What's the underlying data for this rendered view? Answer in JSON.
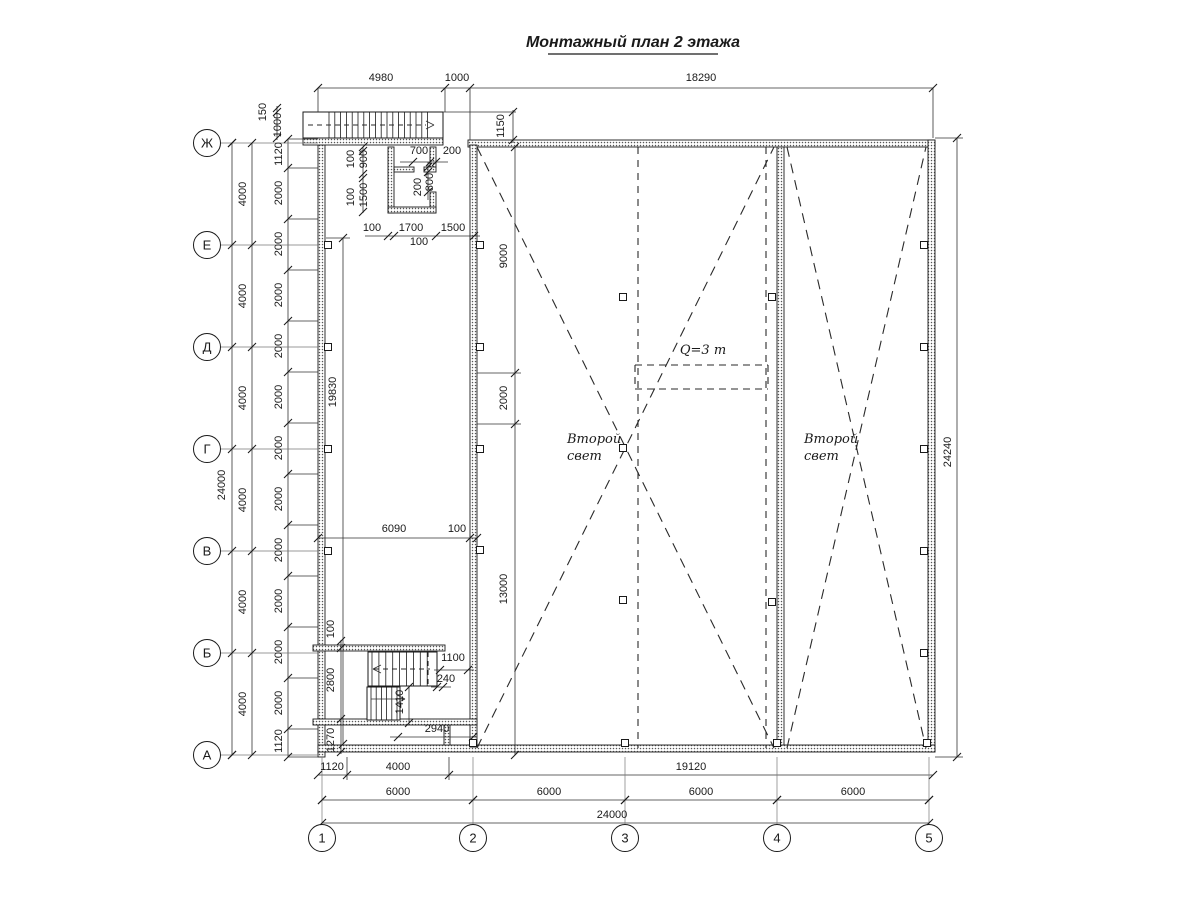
{
  "title": {
    "text": "Монтажный план 2 этажа"
  },
  "colors": {
    "bg": "#ffffff",
    "line": "#1a1a1a",
    "dim": "#333333",
    "hatch_dot": "#555555"
  },
  "axis_bubbles": {
    "rows": [
      {
        "label": "Ж",
        "x": 207,
        "y": 143
      },
      {
        "label": "Е",
        "x": 207,
        "y": 245
      },
      {
        "label": "Д",
        "x": 207,
        "y": 347
      },
      {
        "label": "Г",
        "x": 207,
        "y": 449
      },
      {
        "label": "В",
        "x": 207,
        "y": 551
      },
      {
        "label": "Б",
        "x": 207,
        "y": 653
      },
      {
        "label": "А",
        "x": 207,
        "y": 755
      }
    ],
    "cols": [
      {
        "label": "1",
        "x": 322,
        "y": 838
      },
      {
        "label": "2",
        "x": 473,
        "y": 838
      },
      {
        "label": "3",
        "x": 625,
        "y": 838
      },
      {
        "label": "4",
        "x": 777,
        "y": 838
      },
      {
        "label": "5",
        "x": 929,
        "y": 838
      }
    ]
  },
  "annotations": {
    "second_light_left": {
      "lines": [
        "Второй",
        "свет"
      ],
      "x": 567,
      "y": 443
    },
    "second_light_right": {
      "lines": [
        "Второй",
        "свет"
      ],
      "x": 804,
      "y": 443
    },
    "crane": {
      "text": "Q=3 т",
      "x": 703,
      "y": 354
    }
  },
  "dim_labels": [
    {
      "t": "4980",
      "x": 381,
      "y": 81,
      "r": 0
    },
    {
      "t": "1000",
      "x": 457,
      "y": 81,
      "r": 0
    },
    {
      "t": "18290",
      "x": 701,
      "y": 81,
      "r": 0
    },
    {
      "t": "150",
      "x": 266,
      "y": 112,
      "r": -90
    },
    {
      "t": "1000",
      "x": 281,
      "y": 125,
      "r": -90
    },
    {
      "t": "1150",
      "x": 504,
      "y": 126,
      "r": -90
    },
    {
      "t": "24000",
      "x": 225,
      "y": 485,
      "r": -90
    },
    {
      "t": "4000",
      "x": 246,
      "y": 194,
      "r": -90
    },
    {
      "t": "4000",
      "x": 246,
      "y": 296,
      "r": -90
    },
    {
      "t": "4000",
      "x": 246,
      "y": 398,
      "r": -90
    },
    {
      "t": "4000",
      "x": 246,
      "y": 500,
      "r": -90
    },
    {
      "t": "4000",
      "x": 246,
      "y": 602,
      "r": -90
    },
    {
      "t": "4000",
      "x": 246,
      "y": 704,
      "r": -90
    },
    {
      "t": "1120",
      "x": 282,
      "y": 154,
      "r": -90
    },
    {
      "t": "2000",
      "x": 282,
      "y": 193,
      "r": -90
    },
    {
      "t": "2000",
      "x": 282,
      "y": 244,
      "r": -90
    },
    {
      "t": "2000",
      "x": 282,
      "y": 295,
      "r": -90
    },
    {
      "t": "2000",
      "x": 282,
      "y": 346,
      "r": -90
    },
    {
      "t": "2000",
      "x": 282,
      "y": 397,
      "r": -90
    },
    {
      "t": "2000",
      "x": 282,
      "y": 448,
      "r": -90
    },
    {
      "t": "2000",
      "x": 282,
      "y": 499,
      "r": -90
    },
    {
      "t": "2000",
      "x": 282,
      "y": 550,
      "r": -90
    },
    {
      "t": "2000",
      "x": 282,
      "y": 601,
      "r": -90
    },
    {
      "t": "2000",
      "x": 282,
      "y": 652,
      "r": -90
    },
    {
      "t": "2000",
      "x": 282,
      "y": 703,
      "r": -90
    },
    {
      "t": "1120",
      "x": 282,
      "y": 741,
      "r": -90
    },
    {
      "t": "24240",
      "x": 951,
      "y": 452,
      "r": -90
    },
    {
      "t": "1120",
      "x": 332,
      "y": 770,
      "r": 0
    },
    {
      "t": "4000",
      "x": 398,
      "y": 770,
      "r": 0
    },
    {
      "t": "19120",
      "x": 691,
      "y": 770,
      "r": 0
    },
    {
      "t": "6000",
      "x": 398,
      "y": 795,
      "r": 0
    },
    {
      "t": "6000",
      "x": 549,
      "y": 795,
      "r": 0
    },
    {
      "t": "6000",
      "x": 701,
      "y": 795,
      "r": 0
    },
    {
      "t": "6000",
      "x": 853,
      "y": 795,
      "r": 0
    },
    {
      "t": "24000",
      "x": 612,
      "y": 818,
      "r": 0
    },
    {
      "t": "19830",
      "x": 336,
      "y": 392,
      "r": -90
    },
    {
      "t": "9000",
      "x": 507,
      "y": 256,
      "r": -90
    },
    {
      "t": "2000",
      "x": 507,
      "y": 398,
      "r": -90
    },
    {
      "t": "13000",
      "x": 507,
      "y": 589,
      "r": -90
    },
    {
      "t": "6090",
      "x": 394,
      "y": 532,
      "r": 0
    },
    {
      "t": "100",
      "x": 457,
      "y": 532,
      "r": 0
    },
    {
      "t": "100",
      "x": 354,
      "y": 159,
      "r": -90
    },
    {
      "t": "900",
      "x": 367,
      "y": 159,
      "r": -90
    },
    {
      "t": "100",
      "x": 354,
      "y": 197,
      "r": -90
    },
    {
      "t": "1500",
      "x": 367,
      "y": 195,
      "r": -90
    },
    {
      "t": "700",
      "x": 419,
      "y": 154,
      "r": 0
    },
    {
      "t": "200",
      "x": 452,
      "y": 154,
      "r": 0
    },
    {
      "t": "200",
      "x": 421,
      "y": 187,
      "r": -90
    },
    {
      "t": "800",
      "x": 433,
      "y": 182,
      "r": -90
    },
    {
      "t": "100",
      "x": 372,
      "y": 231,
      "r": 0
    },
    {
      "t": "1700",
      "x": 411,
      "y": 231,
      "r": 0
    },
    {
      "t": "1500",
      "x": 453,
      "y": 231,
      "r": 0
    },
    {
      "t": "100",
      "x": 419,
      "y": 245,
      "r": 0
    },
    {
      "t": "100",
      "x": 334,
      "y": 629,
      "r": -90
    },
    {
      "t": "2800",
      "x": 334,
      "y": 680,
      "r": -90
    },
    {
      "t": "1270",
      "x": 334,
      "y": 740,
      "r": -90
    },
    {
      "t": "1100",
      "x": 453,
      "y": 661,
      "r": 0
    },
    {
      "t": "240",
      "x": 446,
      "y": 682,
      "r": 0
    },
    {
      "t": "1410",
      "x": 403,
      "y": 702,
      "r": -90
    },
    {
      "t": "2940",
      "x": 437,
      "y": 732,
      "r": 0
    }
  ]
}
